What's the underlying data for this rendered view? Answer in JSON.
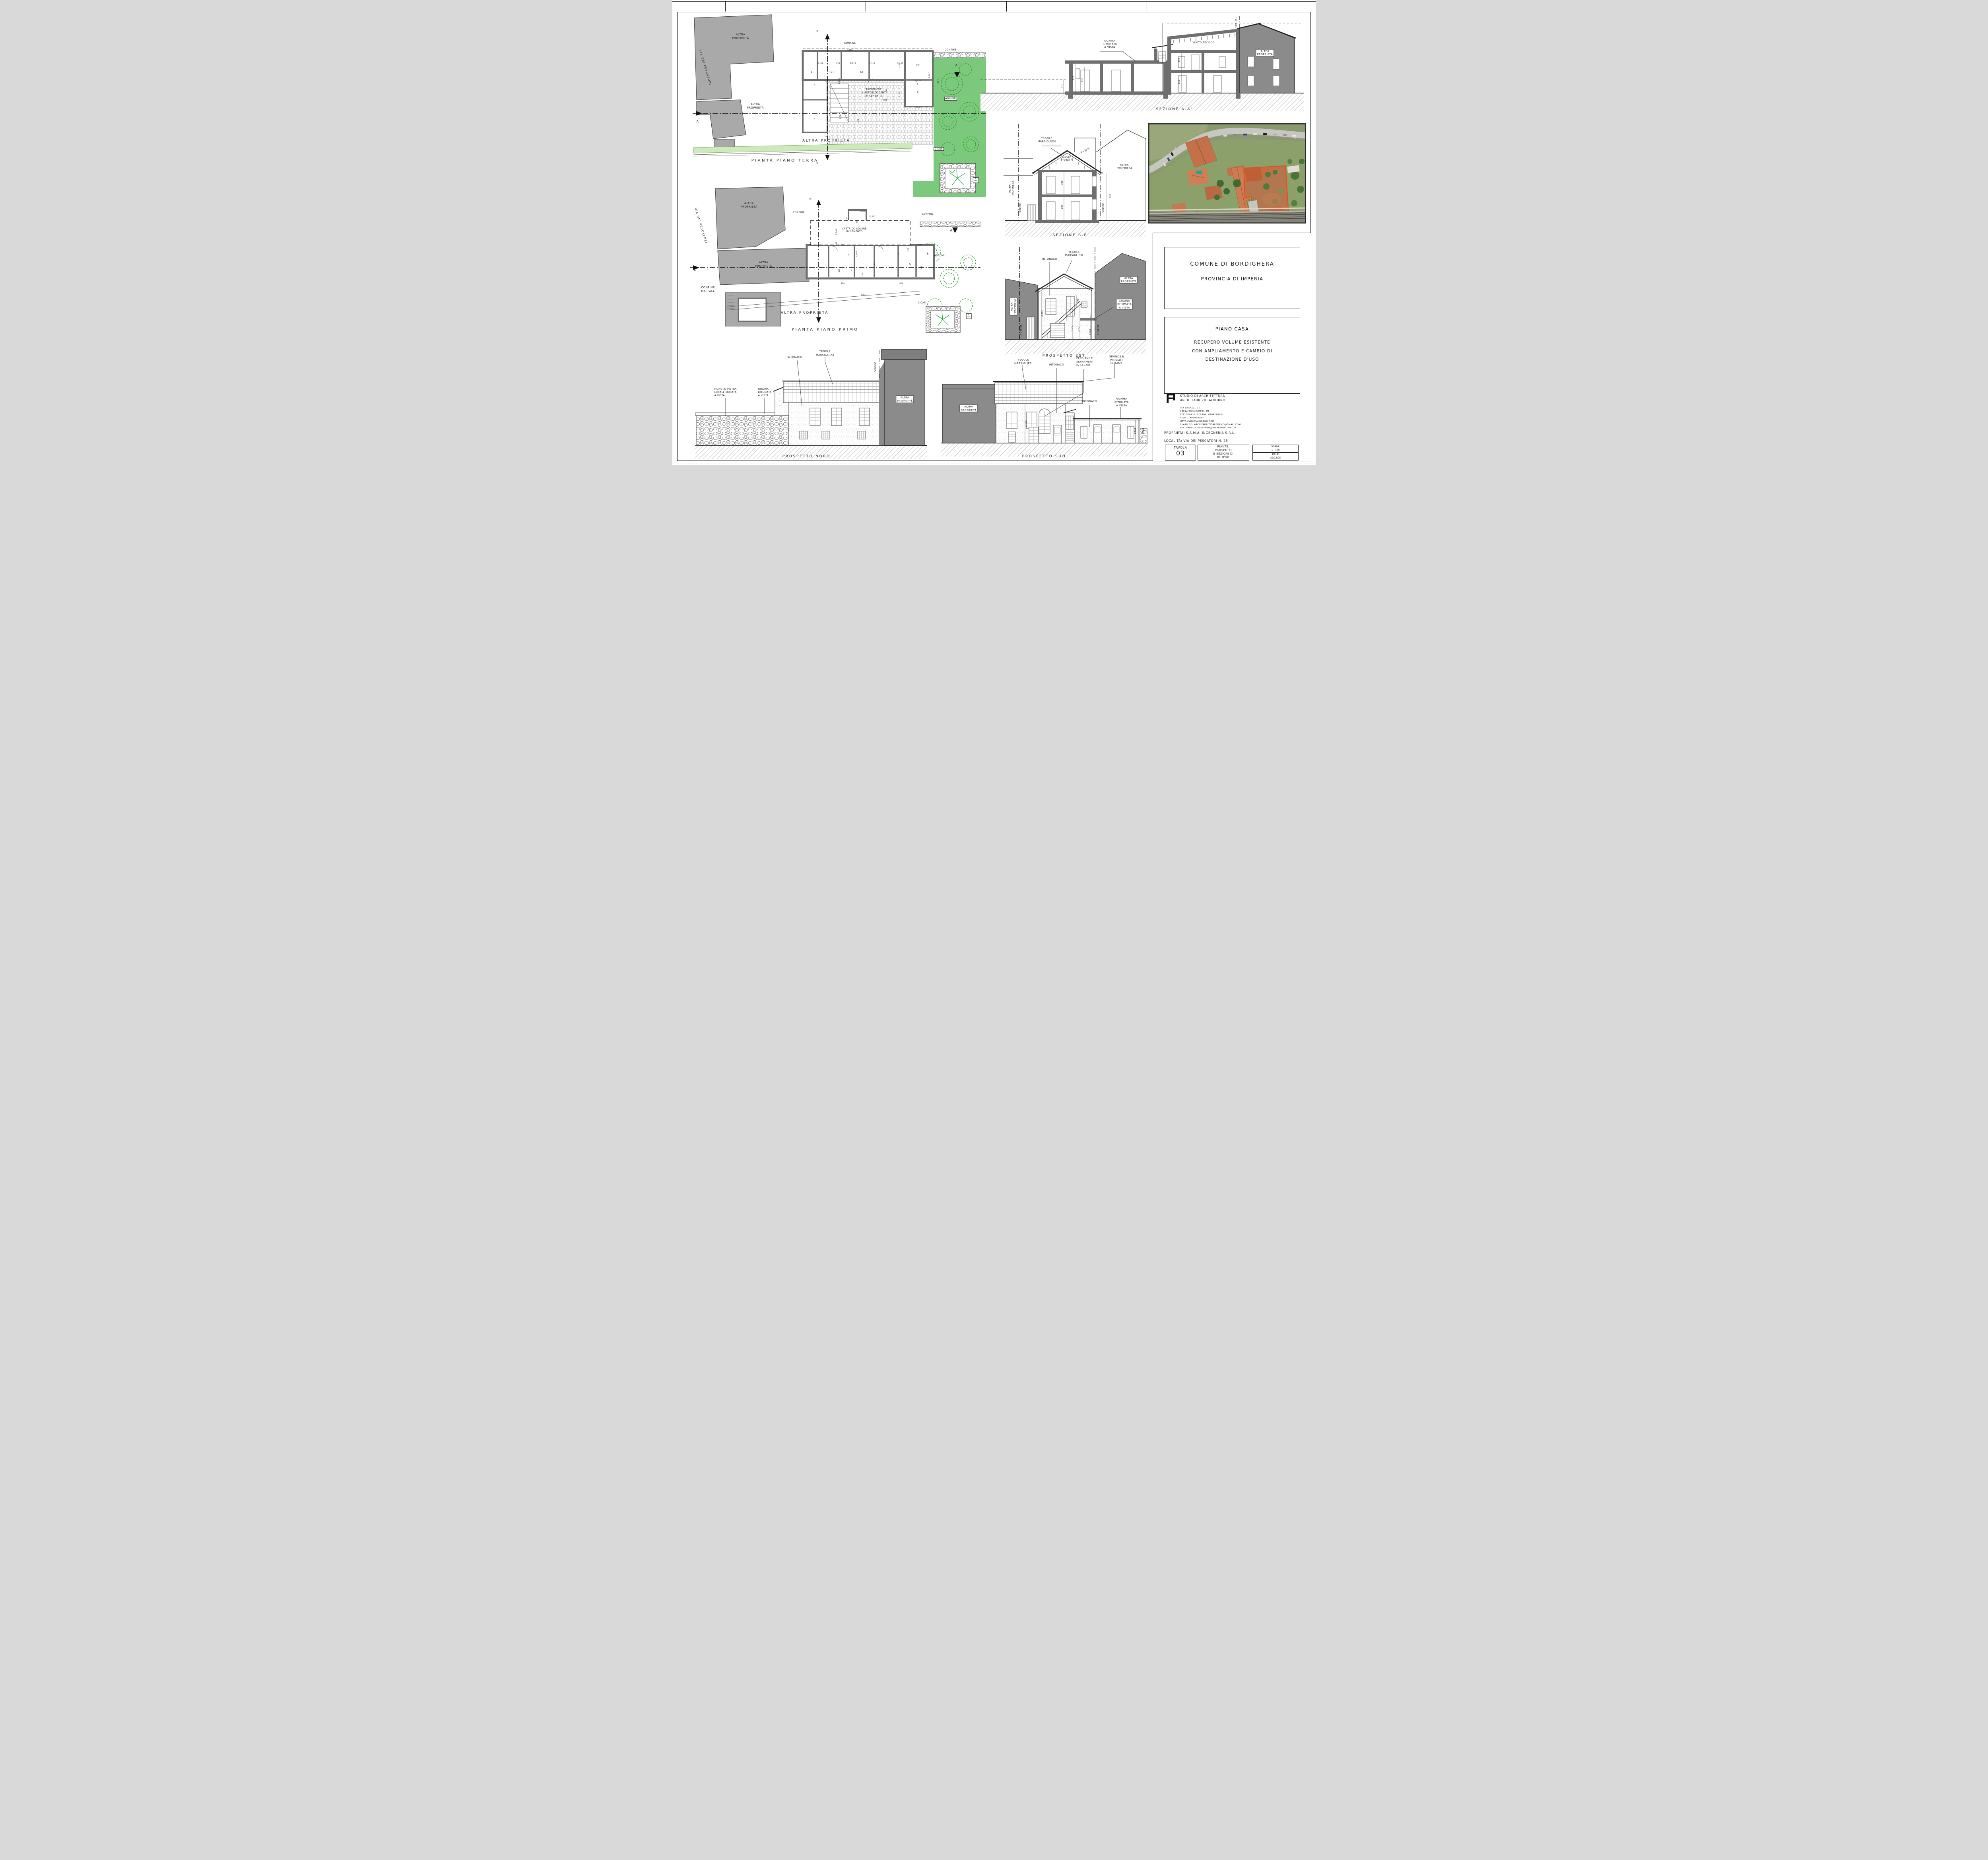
{
  "colors": {
    "garden_green": "#7cc87c",
    "tree_green": "#1f9e1f",
    "neighbor_gray_plan": "#a9a9a9",
    "neighbor_gray_elev": "#8b8b8b",
    "wall_gray": "#6e6e6e",
    "plot_outline_orange": "#f04a10"
  },
  "drawings": {
    "piano_terra": {
      "labels": [
        {
          "t": "ALTRA\nPROPRIETÀ",
          "x": 17,
          "y": 12,
          "s": 7
        },
        {
          "t": "VIA DEI PESCATORI",
          "x": 5,
          "y": 28,
          "s": 7,
          "r": 73,
          "ls": 0.22
        },
        {
          "t": "ALTRA\nPROPRIETÀ",
          "x": 22,
          "y": 48,
          "s": 7
        },
        {
          "t": "CONFINE",
          "x": 54,
          "y": 15.5,
          "s": 6
        },
        {
          "t": "1930",
          "x": 54,
          "y": 19.5,
          "s": 4.8
        },
        {
          "t": "CONFINE",
          "x": 88,
          "y": 19,
          "s": 6
        },
        {
          "t": "K",
          "x": 42,
          "y": 37,
          "s": 6
        },
        {
          "t": "S",
          "x": 42,
          "y": 55,
          "s": 6
        },
        {
          "t": "B",
          "x": 41,
          "y": 30.5,
          "s": 6
        },
        {
          "t": "CT",
          "x": 48,
          "y": 30.5,
          "s": 6
        },
        {
          "t": "CT",
          "x": 58,
          "y": 30.5,
          "s": 6
        },
        {
          "t": "CT",
          "x": 77,
          "y": 27,
          "s": 6
        },
        {
          "t": "C",
          "x": 77,
          "y": 41,
          "s": 6
        },
        {
          "t": "3,118",
          "x": 44,
          "y": 26,
          "s": 4.6
        },
        {
          "t": "105",
          "x": 50,
          "y": 26,
          "s": 4.6
        },
        {
          "t": "1,874",
          "x": 55,
          "y": 26,
          "s": 4.6
        },
        {
          "t": "2,418",
          "x": 61.5,
          "y": 26,
          "s": 4.6
        },
        {
          "t": "5,144",
          "x": 71,
          "y": 26,
          "s": 4.6
        },
        {
          "t": "2,416",
          "x": 50.5,
          "y": 35,
          "s": 4.6,
          "r": -90
        },
        {
          "t": "995",
          "x": 66,
          "y": 45,
          "s": 4.6
        },
        {
          "t": "3,781",
          "x": 51,
          "y": 53,
          "s": 4.6,
          "r": -90
        },
        {
          "t": "445",
          "x": 57,
          "y": 55.5,
          "s": 4.6,
          "r": -90
        },
        {
          "t": "395",
          "x": 46,
          "y": 64,
          "s": 4.6
        },
        {
          "t": "2,434",
          "x": 71,
          "y": 27,
          "s": 4.6,
          "r": -90
        },
        {
          "t": "3,256",
          "x": 77,
          "y": 35,
          "s": 4.6
        },
        {
          "t": "3,752",
          "x": 71,
          "y": 42,
          "s": 4.6,
          "r": -90
        },
        {
          "t": "305",
          "x": 77,
          "y": 49,
          "s": 4.6
        },
        {
          "t": "605",
          "x": 84,
          "y": 35,
          "s": 4.6,
          "r": -90
        },
        {
          "t": "630",
          "x": 66.5,
          "y": 40,
          "s": 4.6,
          "r": -90
        },
        {
          "t": "2,747",
          "x": 81,
          "y": 32,
          "s": 4.6,
          "r": -90
        },
        {
          "t": "PAVIMENTO\nIN AUTOBLOCCANTI\nIN CEMENTO",
          "x": 62,
          "y": 41,
          "s": 6
        },
        {
          "t": "AGRUMI",
          "x": 88,
          "y": 44,
          "s": 6,
          "b": 1
        },
        {
          "t": "CICAS",
          "x": 84,
          "y": 70,
          "s": 6,
          "b": 1
        },
        {
          "t": "V\nIRR",
          "x": 96.5,
          "y": 86,
          "s": 4.6,
          "b": 1
        },
        {
          "t": "ALTRA PROPRIETÀ",
          "x": 46,
          "y": 66,
          "s": 9,
          "ls": 0.3
        },
        {
          "t": "A",
          "x": 2.5,
          "y": 56,
          "s": 8
        },
        {
          "t": "A",
          "x": 90,
          "y": 27,
          "s": 8
        },
        {
          "t": "B",
          "x": 43,
          "y": 9.5,
          "s": 7
        },
        {
          "t": "B",
          "x": 43,
          "y": 77.5,
          "s": 7
        },
        {
          "t": "PIANTA PIANO TERRA",
          "x": 32,
          "y": 76,
          "s": 10,
          "ls": 0.35
        }
      ]
    },
    "piano_primo": {
      "labels": [
        {
          "t": "ALTRA\nPROPRIETÀ",
          "x": 21,
          "y": 13,
          "s": 7
        },
        {
          "t": "VIA DEI PESCATORI",
          "x": 4.5,
          "y": 27,
          "s": 7,
          "r": 73,
          "ls": 0.22
        },
        {
          "t": "ALTRA\nPROPRIETÀ",
          "x": 26,
          "y": 53,
          "s": 7
        },
        {
          "t": "CONFINE\nMAPPALE",
          "x": 7,
          "y": 70,
          "s": 7
        },
        {
          "t": "CONFINE",
          "x": 38,
          "y": 18,
          "s": 6
        },
        {
          "t": "CONFINE",
          "x": 82,
          "y": 19,
          "s": 6
        },
        {
          "t": "LASTRICO SOLARE\nIN CEMENTO",
          "x": 57,
          "y": 30,
          "s": 6
        },
        {
          "t": "AGRUMI",
          "x": 86,
          "y": 47,
          "s": 6
        },
        {
          "t": "CICAS",
          "x": 80,
          "y": 79,
          "s": 6
        },
        {
          "t": "V\nIRR",
          "x": 96,
          "y": 88,
          "s": 4.6,
          "b": 1
        },
        {
          "t": "ALTRA PROPRIETÀ",
          "x": 40,
          "y": 86,
          "s": 9,
          "ls": 0.3
        },
        {
          "t": "C",
          "x": 55,
          "y": 47,
          "s": 6
        },
        {
          "t": "C",
          "x": 56,
          "y": 57,
          "s": 6
        },
        {
          "t": "K",
          "x": 72,
          "y": 46,
          "s": 6
        },
        {
          "t": "S",
          "x": 76,
          "y": 53,
          "s": 6
        },
        {
          "t": "B",
          "x": 82,
          "y": 46,
          "s": 6
        },
        {
          "t": "WC",
          "x": 58,
          "y": 24,
          "s": 5,
          "r": -90
        },
        {
          "t": "10,507",
          "x": 63,
          "y": 21,
          "s": 4.6
        },
        {
          "t": "0,950",
          "x": 60,
          "y": 17.5,
          "s": 4.6
        },
        {
          "t": "1,448",
          "x": 79,
          "y": 40,
          "s": 4.6
        },
        {
          "t": "150",
          "x": 75.5,
          "y": 43,
          "s": 4.6,
          "r": -90
        },
        {
          "t": "355",
          "x": 53,
          "y": 40,
          "s": 4.6
        },
        {
          "t": "3,046",
          "x": 58,
          "y": 46,
          "s": 4.6,
          "r": -90
        },
        {
          "t": "6,306",
          "x": 64,
          "y": 53,
          "s": 4.6,
          "r": -90
        },
        {
          "t": "500",
          "x": 80,
          "y": 55,
          "s": 4.6,
          "r": -90
        },
        {
          "t": "320",
          "x": 60,
          "y": 60,
          "s": 4.6,
          "r": -90
        },
        {
          "t": "490",
          "x": 53,
          "y": 66,
          "s": 4.6
        },
        {
          "t": "410",
          "x": 73,
          "y": 66,
          "s": 4.6
        },
        {
          "t": "1055",
          "x": 60,
          "y": 74,
          "s": 4.6
        },
        {
          "t": "2,906",
          "x": 51,
          "y": 31,
          "s": 4.6,
          "r": -90
        },
        {
          "t": "105",
          "x": 51,
          "y": 39,
          "s": 4.6,
          "r": -90
        },
        {
          "t": "445",
          "x": 52,
          "y": 57,
          "s": 4.6,
          "r": -90
        },
        {
          "t": "150",
          "x": 54.5,
          "y": 22,
          "s": 4.6,
          "r": -90
        },
        {
          "t": "A",
          "x": 2.5,
          "y": 57,
          "s": 8
        },
        {
          "t": "A",
          "x": 90,
          "y": 30,
          "s": 8
        },
        {
          "t": "B",
          "x": 42,
          "y": 9,
          "s": 7
        },
        {
          "t": "B",
          "x": 42,
          "y": 86,
          "s": 7
        },
        {
          "t": "PIANTA PIANO PRIMO",
          "x": 47,
          "y": 97,
          "s": 10,
          "ls": 0.35
        }
      ]
    },
    "prospetto_nord": {
      "labels": [
        {
          "t": "TEGOLE\nMARSIGLIESI",
          "x": 56,
          "y": 7,
          "s": 6.5
        },
        {
          "t": "INTONACO",
          "x": 43,
          "y": 10.5,
          "s": 6.5
        },
        {
          "t": "MURO IN PIETRA\nLOCALE MURATA\nA VISTA",
          "x": 13,
          "y": 41,
          "s": 6.2,
          "al": "left"
        },
        {
          "t": "GUAINA\nBITUMATA\nA VISTA",
          "x": 30,
          "y": 41,
          "s": 6.2,
          "al": "left"
        },
        {
          "t": "ALTRA\nPROPRIETÀ",
          "x": 90.5,
          "y": 47,
          "s": 6.5,
          "b": 1
        },
        {
          "t": "CONFINE",
          "x": 78,
          "y": 19,
          "s": 5.5,
          "r": -90
        },
        {
          "t": "PROSPETTO NORD",
          "x": 48,
          "y": 97,
          "s": 9,
          "ls": 0.3
        }
      ]
    },
    "prospetto_sud": {
      "labels": [
        {
          "t": "TEGOLE\nMARSIGLIESI",
          "x": 40,
          "y": 8,
          "s": 6.5
        },
        {
          "t": "INTONACO",
          "x": 56,
          "y": 11,
          "s": 6.5
        },
        {
          "t": "PERSIANE E\nSERRAMENTI\nIN LEGNO",
          "x": 70,
          "y": 8,
          "s": 6.5,
          "al": "left"
        },
        {
          "t": "GRONDE E\nPLUVIALI\nIN RAME",
          "x": 85,
          "y": 6.5,
          "s": 6.5
        },
        {
          "t": "ALTRA\nPROPRIETÀ",
          "x": 13.5,
          "y": 52,
          "s": 6.5,
          "b": 1
        },
        {
          "t": "INTONACO",
          "x": 72,
          "y": 45,
          "s": 6.5
        },
        {
          "t": "GUAINA\nBITUMATA\nA VISTA",
          "x": 87.5,
          "y": 46,
          "s": 6.5
        },
        {
          "t": "6,500",
          "x": 41.5,
          "y": 66,
          "s": 5,
          "r": -90
        },
        {
          "t": "2,504",
          "x": 94.2,
          "y": 73,
          "s": 5,
          "r": -90
        },
        {
          "t": "2,704",
          "x": 98,
          "y": 73,
          "s": 5,
          "r": -90
        },
        {
          "t": "PROSPETTO SUD",
          "x": 50,
          "y": 97.5,
          "s": 9,
          "ls": 0.3
        }
      ]
    },
    "prospetto_est": {
      "labels": [
        {
          "t": "INTONACO",
          "x": 32,
          "y": 13,
          "s": 6.5
        },
        {
          "t": "TEGOLE\nMARSIGLIESI",
          "x": 49,
          "y": 8.5,
          "s": 6.5
        },
        {
          "t": "ALTRA\nPROPRIETÀ",
          "x": 7,
          "y": 54,
          "s": 6.5,
          "r": -90,
          "b": 1
        },
        {
          "t": "ALTRA\nPROPRIETÀ",
          "x": 87,
          "y": 31,
          "s": 6.5,
          "b": 1
        },
        {
          "t": "GUAINA\nBITUMATA\nA VISTA",
          "x": 84,
          "y": 52,
          "s": 6.5,
          "b": 1
        },
        {
          "t": "CONFINE",
          "x": 12.5,
          "y": 74,
          "s": 5.5,
          "r": -90
        },
        {
          "t": "CONFINE",
          "x": 66,
          "y": 74,
          "s": 5.5,
          "r": -90
        },
        {
          "t": "6,500",
          "x": 27,
          "y": 60,
          "s": 5,
          "r": -90
        },
        {
          "t": "270",
          "x": 52,
          "y": 49,
          "s": 5,
          "r": -90
        },
        {
          "t": "2,504",
          "x": 48,
          "y": 73,
          "s": 5,
          "r": -90
        },
        {
          "t": "2,704",
          "x": 52.5,
          "y": 73,
          "s": 5,
          "r": -90
        },
        {
          "t": "1,700",
          "x": 60.5,
          "y": 76,
          "s": 5,
          "r": -90
        },
        {
          "t": "PROSPETTO EST",
          "x": 42,
          "y": 97,
          "s": 9,
          "ls": 0.3
        }
      ]
    },
    "sezione_aa": {
      "labels": [
        {
          "t": "GUAINA\nBITUMATA\nA VISTA",
          "x": 40,
          "y": 29,
          "s": 6.5
        },
        {
          "t": "VUOTO TECNICO",
          "x": 69,
          "y": 28,
          "s": 6
        },
        {
          "t": "ALTRA\nPROPRIETÀ",
          "x": 88,
          "y": 38,
          "s": 6.5,
          "b": 1
        },
        {
          "t": "CONFINE",
          "x": 79.2,
          "y": 7,
          "s": 5.5,
          "r": -90
        },
        {
          "t": "650",
          "x": 55.2,
          "y": 45,
          "s": 5,
          "r": -90
        },
        {
          "t": "170",
          "x": 25.2,
          "y": 71,
          "s": 5,
          "r": -90
        },
        {
          "t": "270",
          "x": 28.8,
          "y": 63,
          "s": 5,
          "r": -90
        },
        {
          "t": "250",
          "x": 31.6,
          "y": 65,
          "s": 5,
          "r": -90
        },
        {
          "t": "270",
          "x": 56.5,
          "y": 41,
          "s": 5,
          "r": -90
        },
        {
          "t": "260",
          "x": 61.5,
          "y": 45,
          "s": 5,
          "r": -90
        },
        {
          "t": "260",
          "x": 61.5,
          "y": 67,
          "s": 5,
          "r": -90
        },
        {
          "t": "SEZIONE A-A'",
          "x": 60,
          "y": 95,
          "s": 9,
          "ls": 0.3
        }
      ]
    },
    "sezione_bb": {
      "labels": [
        {
          "t": "TEGOLE\nMARSIGLIESI",
          "x": 30,
          "y": 16,
          "s": 6.5
        },
        {
          "t": "VUOTO\nTECNICO",
          "x": 44,
          "y": 32,
          "s": 6
        },
        {
          "t": "P=35%",
          "x": 57,
          "y": 25,
          "s": 6,
          "r": -29
        },
        {
          "t": "ALTRA\nPROPRIETÀ",
          "x": 5.5,
          "y": 56,
          "s": 6.5,
          "r": -90
        },
        {
          "t": "ALTRA\nPROPRIETÀ",
          "x": 84,
          "y": 38,
          "s": 6.5
        },
        {
          "t": "CONFINE",
          "x": 12,
          "y": 72,
          "s": 5.5,
          "r": -90
        },
        {
          "t": "CONFINE",
          "x": 69.5,
          "y": 72,
          "s": 5.5,
          "r": -90
        },
        {
          "t": "290",
          "x": 41,
          "y": 51,
          "s": 5,
          "r": -90
        },
        {
          "t": "290",
          "x": 41,
          "y": 71,
          "s": 5,
          "r": -90
        },
        {
          "t": "650",
          "x": 74,
          "y": 62,
          "s": 5,
          "r": -90
        },
        {
          "t": "SEZIONE B-B'",
          "x": 47,
          "y": 95,
          "s": 9,
          "ls": 0.3
        }
      ]
    },
    "aerial": {
      "plot_outline_color": "#f04a10",
      "labels": [
        {
          "t": "BUS",
          "x": 93,
          "y": 14,
          "s": 4.5,
          "r": 75,
          "c": "#f5f0e0"
        }
      ]
    }
  },
  "title_block": {
    "comune": "COMUNE DI BORDIGHERA",
    "provincia": "PROVINCIA DI IMPERIA",
    "piano_casa": "PIANO CASA",
    "descrizione": "RECUPERO VOLUME ESISTENTE\nCON AMPLIAMENTO E CAMBIO DI\nDESTINAZIONE D'USO",
    "studio": "STUDIO DI ARCHITETTURA\nARCH. FABRIZIO ALBORNO",
    "indirizzo": "VIA LAGAZZI, 10\n18012 BORDIGHERA, IM\nTEL: 0184262529 FAX: 0184268661\nP.IVA 01401970080\nHTTP://WWW.ALBORNO.COM\nE-MAIL TO: ARCH.FABRIZIOALBORNO@GMAIL.COM\nPEC: FABRIZIO.ALBORNO@ARCHIWORLDPEC.IT",
    "proprieta": "PROPRIETÀ: S.A.M.A. INGEGNERIA S.R.L.",
    "localita": "LOCALITÀ: VIA DEI PESCATORI N. 25",
    "tavola_label": "TAVOLA",
    "tavola_numero": "03",
    "oggetto": "PIANTE,\nPROSPETTI\nE SEZIONI DI\nRILIEVO",
    "scala_label": "SCALA:",
    "scala_valore": "1 : 100",
    "data_label": "DATA:",
    "data_valore": "22/12/25"
  }
}
